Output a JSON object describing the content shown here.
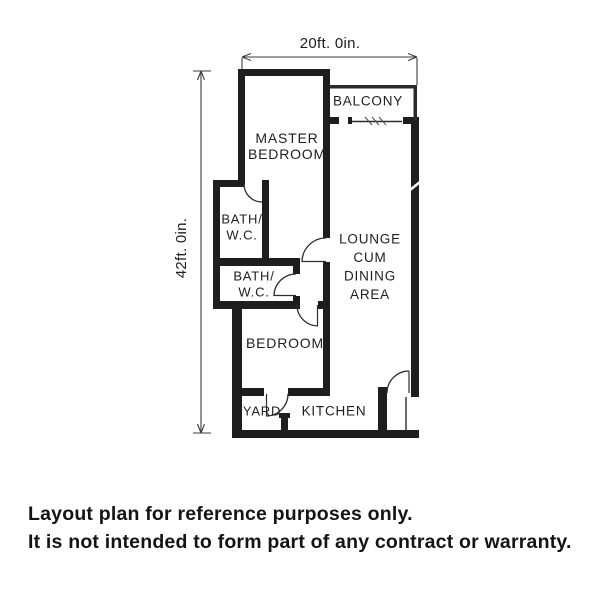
{
  "plan": {
    "dimensions": {
      "width_label": "20ft. 0in.",
      "height_label": "42ft. 0in."
    },
    "rooms": [
      {
        "id": "balcony",
        "lines": [
          "BALCONY"
        ],
        "x": 368,
        "y": 101,
        "fs": 13.5,
        "lh": 17
      },
      {
        "id": "master-bedroom",
        "lines": [
          "MASTER",
          "BEDROOM"
        ],
        "x": 287,
        "y": 138,
        "fs": 14,
        "lh": 16
      },
      {
        "id": "bath-wc-1",
        "lines": [
          "BATH/",
          "W.C."
        ],
        "x": 242,
        "y": 219,
        "fs": 13,
        "lh": 16
      },
      {
        "id": "lounge",
        "lines": [
          "LOUNGE",
          "CUM",
          "DINING",
          "AREA"
        ],
        "x": 370,
        "y": 239,
        "fs": 13.5,
        "lh": 18.5
      },
      {
        "id": "bath-wc-2",
        "lines": [
          "BATH/",
          "W.C."
        ],
        "x": 254,
        "y": 276,
        "fs": 13,
        "lh": 16
      },
      {
        "id": "bedroom",
        "lines": [
          "BEDROOM"
        ],
        "x": 285,
        "y": 343,
        "fs": 14,
        "lh": 16
      },
      {
        "id": "yard",
        "lines": [
          "YARD"
        ],
        "x": 262,
        "y": 411,
        "fs": 13,
        "lh": 16
      },
      {
        "id": "kitchen",
        "lines": [
          "KITCHEN"
        ],
        "x": 334,
        "y": 411,
        "fs": 13.5,
        "lh": 16
      }
    ]
  },
  "disclaimer": {
    "line1": "Layout plan for reference purposes only.",
    "line2": "It is not intended to form part of any contract or warranty."
  },
  "colors": {
    "ink": "#1e1e1e",
    "background": "#ffffff"
  }
}
